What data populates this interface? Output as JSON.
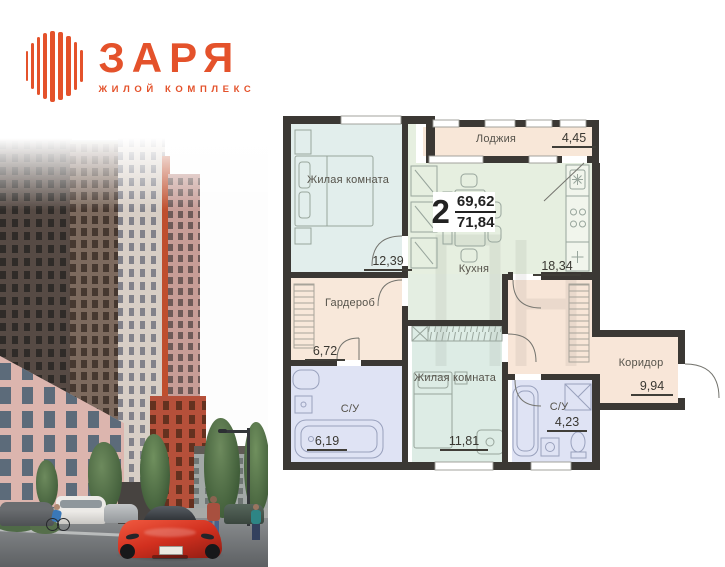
{
  "logo": {
    "title": "ЗАРЯ",
    "subtitle": "ЖИЛОЙ КОМПЛЕКС"
  },
  "apartment": {
    "rooms_count": "2",
    "area_upper": "69,62",
    "area_lower": "71,84"
  },
  "floorplan": {
    "rooms": [
      {
        "id": "loggia",
        "label": "Лоджия",
        "area": "4,45"
      },
      {
        "id": "bedroom-top",
        "label": "Жилая комната",
        "area": "12,39"
      },
      {
        "id": "kitchen",
        "label": "Кухня",
        "area": "18,34"
      },
      {
        "id": "wardrobe",
        "label": "Гардероб",
        "area": "6,72"
      },
      {
        "id": "bathroom-left",
        "label": "С/У",
        "area": "6,19"
      },
      {
        "id": "bedroom-bottom",
        "label": "Жилая комната",
        "area": "11,81"
      },
      {
        "id": "bathroom-right",
        "label": "С/У",
        "area": "4,23"
      },
      {
        "id": "corridor",
        "label": "Коридор",
        "area": "9,94"
      }
    ]
  },
  "colors": {
    "brand_orange": "#e4522b",
    "wall_dark": "#3b3834",
    "room_peach": "#f8e7d8",
    "room_blue": "#e2eeec",
    "room_green": "#e6efe0",
    "room_mint": "#ddece5",
    "room_lavender": "#dfe3f4"
  }
}
